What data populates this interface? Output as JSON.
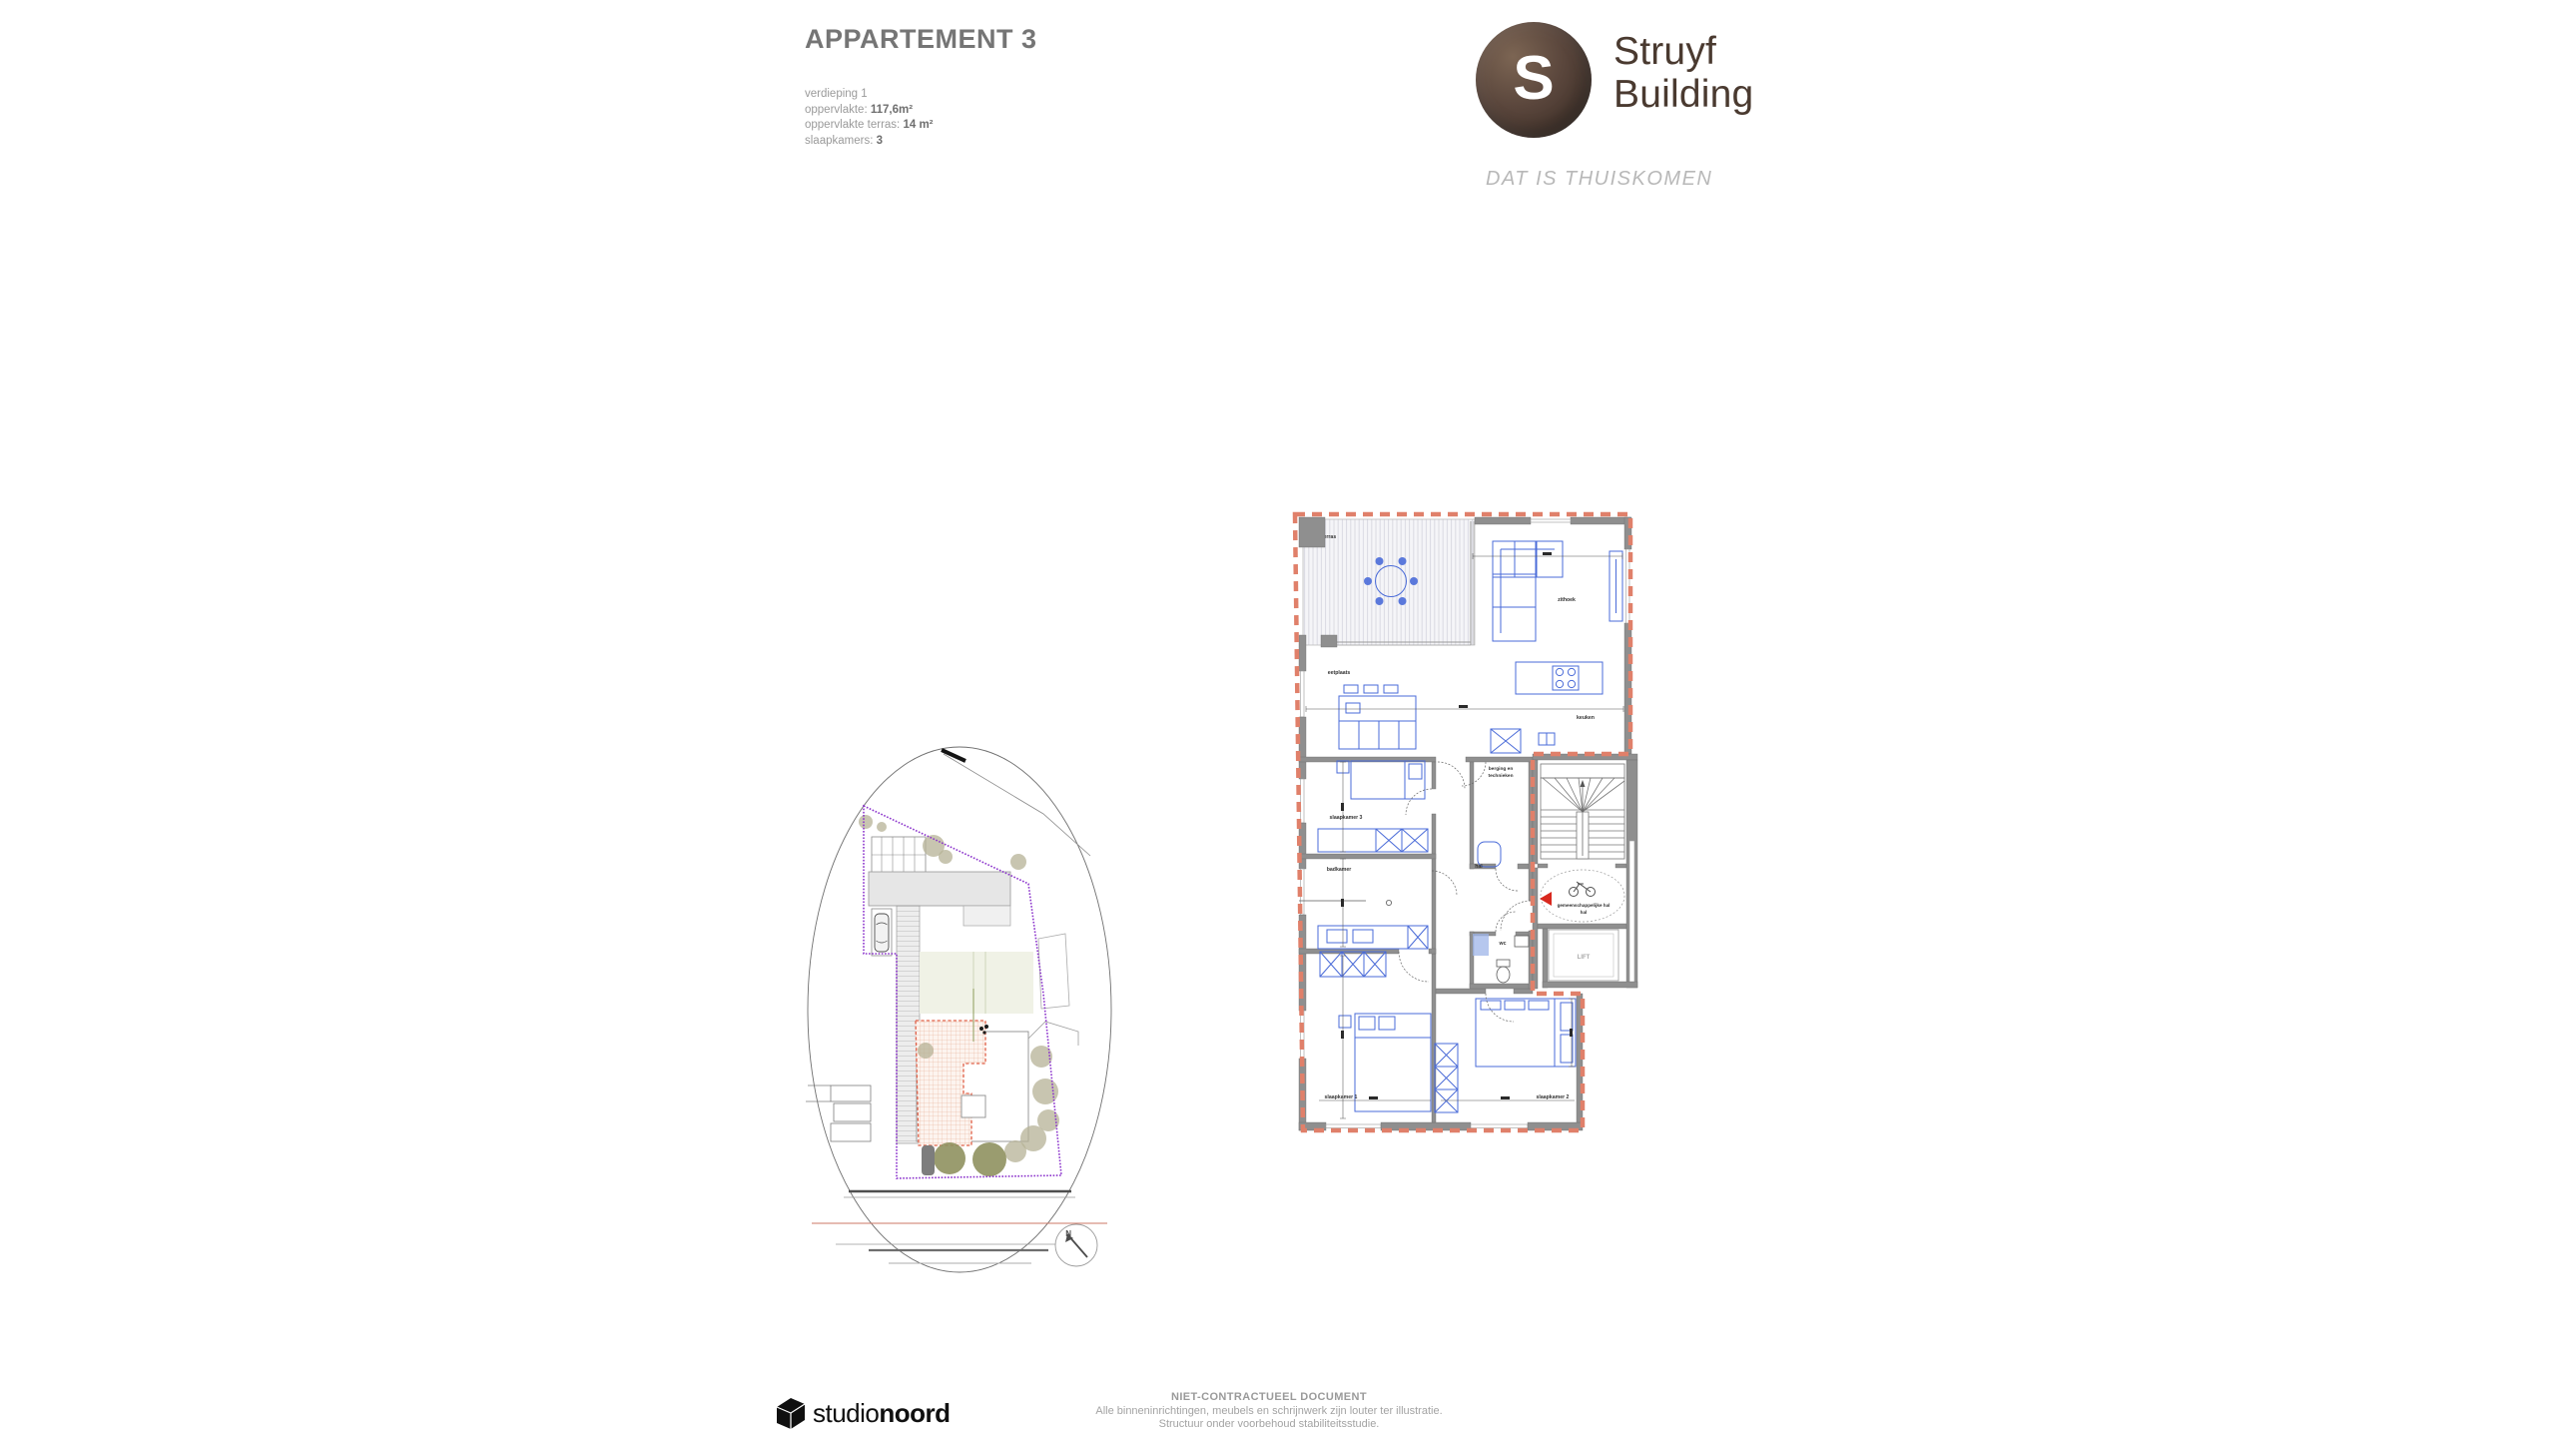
{
  "header": {
    "title": "APPARTEMENT 3",
    "floor": "verdieping 1",
    "area_label": "oppervlakte:",
    "area_value": "117,6m²",
    "terrace_label": "oppervlakte terras:",
    "terrace_value": "14 m²",
    "bedrooms_label": "slaapkamers:",
    "bedrooms_value": "3"
  },
  "brand": {
    "initial": "S",
    "name_line1": "Struyf",
    "name_line2": "Building",
    "tagline": "DAT IS THUISKOMEN"
  },
  "floorplan": {
    "labels": {
      "terras": "terras",
      "zithoek": "zithoek",
      "keuken": "keuken",
      "eetplaats": "eetplaats",
      "slaapkamer1": "slaapkamer 1",
      "slaapkamer2": "slaapkamer 2",
      "slaapkamer3": "slaapkamer 3",
      "badkamer": "badkamer",
      "berging_line1": "berging en",
      "berging_line2": "technieken",
      "hal": "hal",
      "wc": "wc",
      "lift": "LIFT",
      "gemeenschappelijke_hal": "gemeenschappelijke hal"
    }
  },
  "siteplan": {
    "north": "N"
  },
  "footer": {
    "studio_word1": "studio",
    "studio_word2": "noord",
    "disclaimer_title": "NIET-CONTRACTUEEL DOCUMENT",
    "disclaimer_line1": "Alle binneninrichtingen, meubels en schrijnwerk zijn louter ter illustratie.",
    "disclaimer_line2": "Structuur onder voorbehoud stabiliteitsstudie."
  },
  "colors": {
    "boundary": "#e0806a",
    "walls": "#8f8f8f",
    "furniture": "#4a6bd8",
    "site_boundary": "#8b33cc",
    "brand_brown": "#4a3a30",
    "accent_red": "#d8281e"
  }
}
